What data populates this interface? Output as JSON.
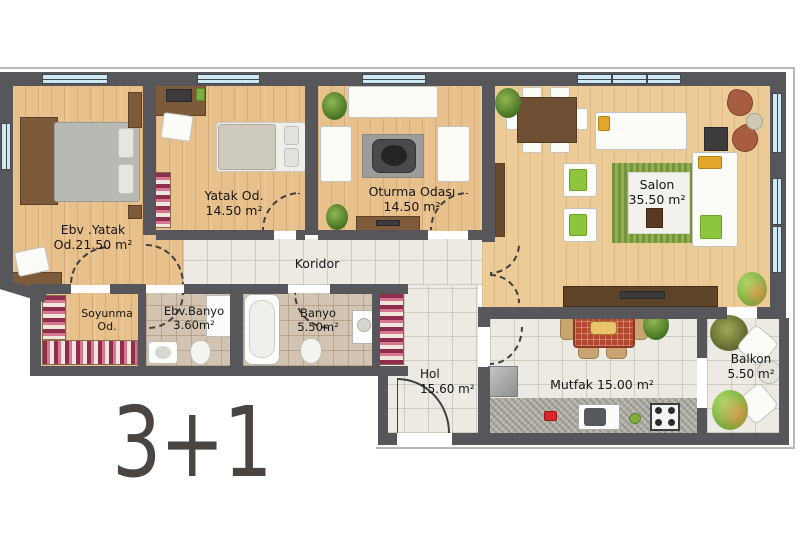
{
  "title": "3+1",
  "rooms": {
    "ebv_yatak": {
      "name": "Ebv .Yatak",
      "area": "Od.21.50 m²"
    },
    "yatak": {
      "name": "Yatak Od.",
      "area": "14.50 m²"
    },
    "oturma": {
      "name": "Oturma Odası",
      "area": "14.50 m²"
    },
    "salon": {
      "name": "Salon",
      "area": "35.50 m²"
    },
    "koridor": {
      "name": "Koridor"
    },
    "soyunma": {
      "name": "Soyunma",
      "area": "Od."
    },
    "ebv_banyo": {
      "name": "Ebv.Banyo",
      "area": "3.60m²"
    },
    "banyo": {
      "name": "Banyo",
      "area": "5.50m²"
    },
    "hol": {
      "name": "Hol",
      "area": "15.60 m²"
    },
    "mutfak": {
      "name": "Mutfak 15.00 m²"
    },
    "balkon": {
      "name": "Balkon",
      "area": "5.50 m²"
    }
  },
  "colors": {
    "wall": "#57575B",
    "wood_floor": "#E8C08C",
    "tile_floor": "#ECEAE2",
    "bath_tile": "#D2C4B1",
    "window_glass": "#CDE9F5",
    "rug_green": "#93B04E",
    "kitchen_table_red": "#B5492F",
    "label_text": "#161616",
    "type_text": "#4B4542"
  }
}
